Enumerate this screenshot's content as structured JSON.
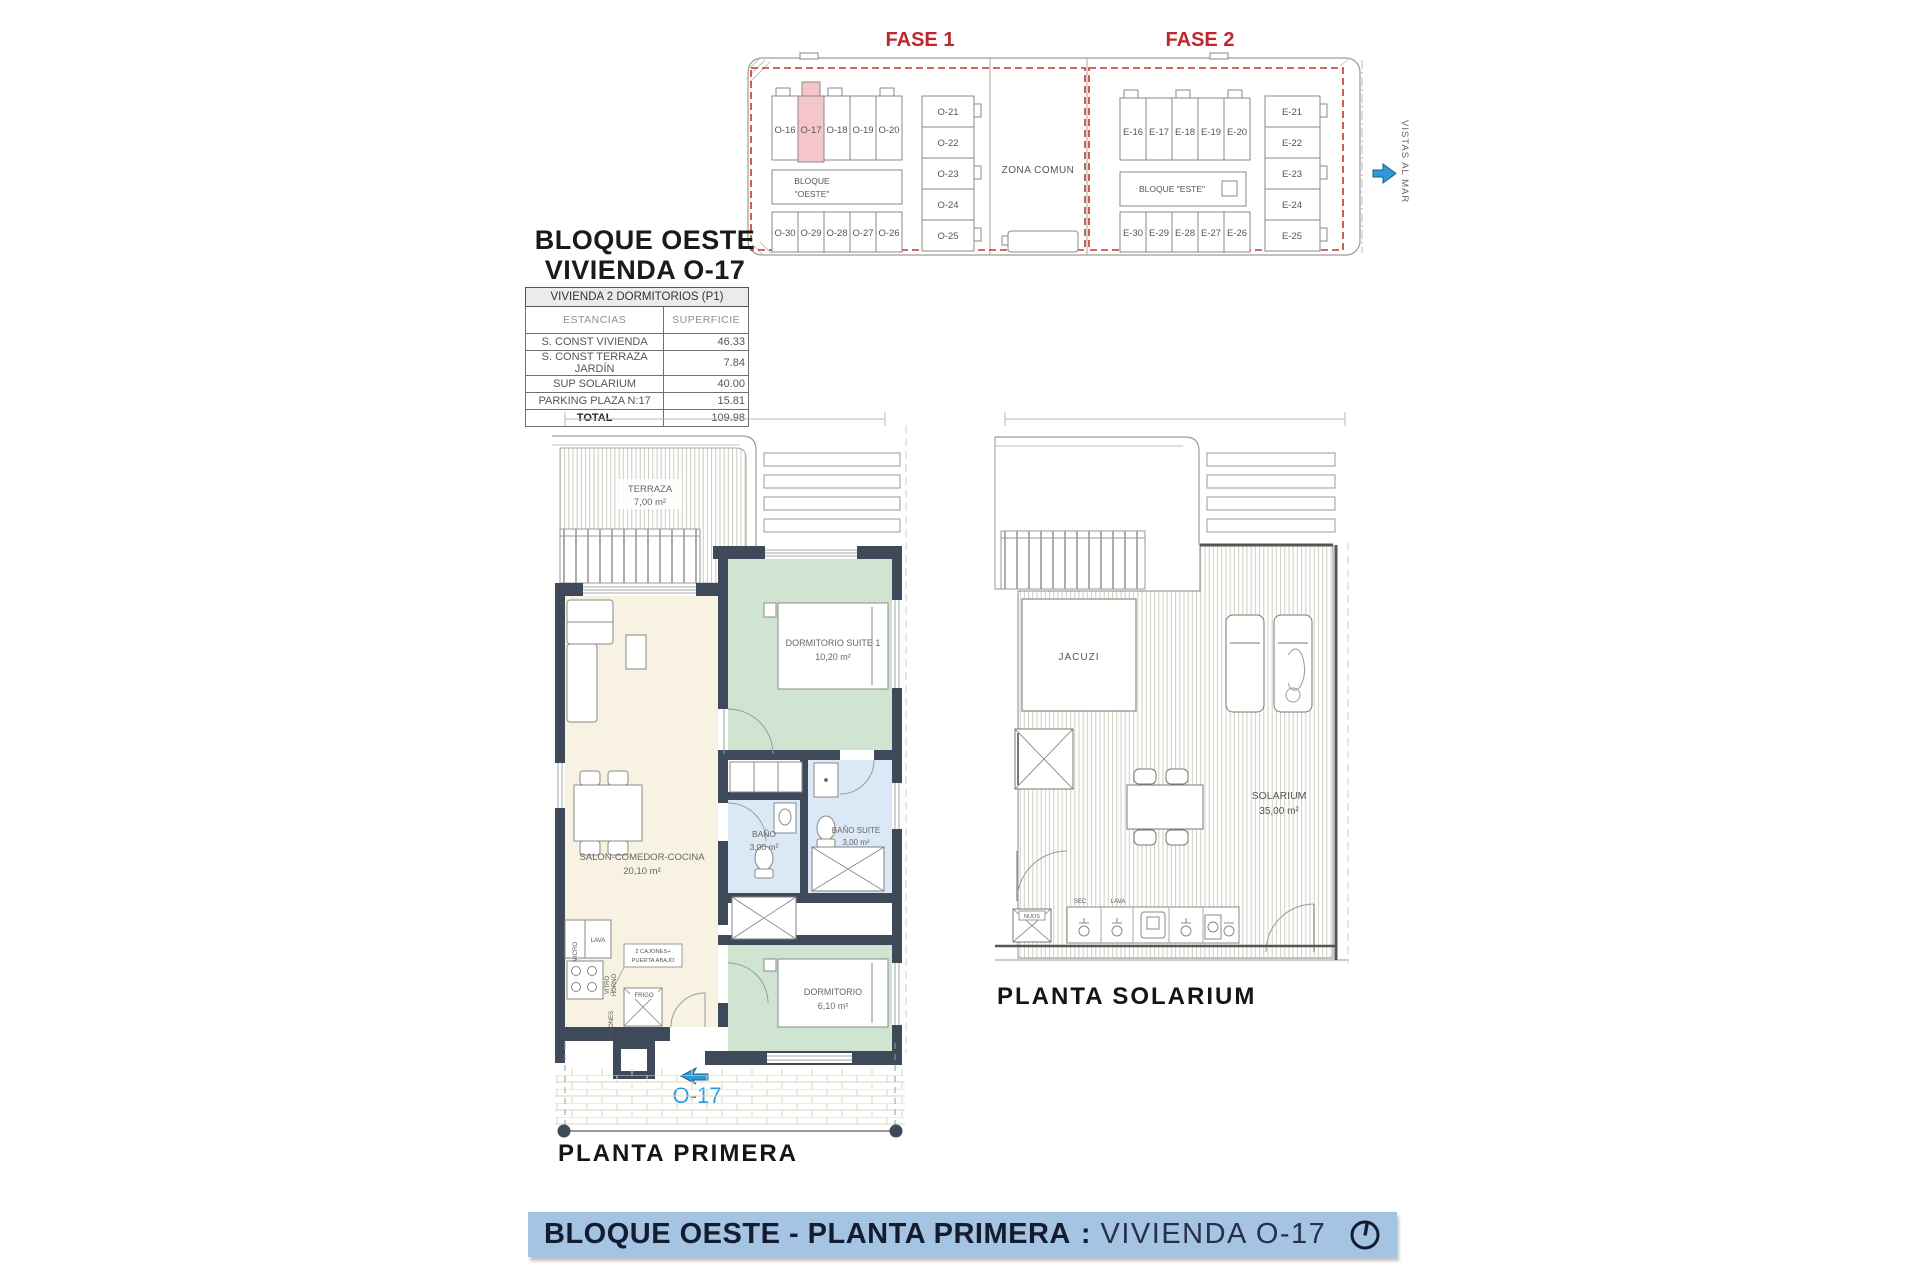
{
  "colors": {
    "accent_red": "#c0272d",
    "highlight_pink": "#f5c6c9",
    "banner_blue": "#a5c3e3",
    "navy_text": "#141c30",
    "wall_dark": "#3e4a59",
    "room_cream": "#f8f2e2",
    "room_green": "#cfe5d1",
    "room_blue": "#dbe8f5",
    "unit_accent_blue": "#2e9ad7"
  },
  "site_plan": {
    "fase1": {
      "label": "FASE 1",
      "top_row": [
        "O-16",
        "O-17",
        "O-18",
        "O-19",
        "O-20"
      ],
      "bottom_row": [
        "O-30",
        "O-29",
        "O-28",
        "O-27",
        "O-26"
      ],
      "right_column": [
        "O-21",
        "O-22",
        "O-23",
        "O-24",
        "O-25"
      ],
      "highlighted_unit": "O-17",
      "block_label_line1": "BLOQUE",
      "block_label_line2": "\"OESTE\""
    },
    "fase2": {
      "label": "FASE 2",
      "top_row": [
        "E-16",
        "E-17",
        "E-18",
        "E-19",
        "E-20"
      ],
      "bottom_row": [
        "E-30",
        "E-29",
        "E-28",
        "E-27",
        "E-26"
      ],
      "right_column": [
        "E-21",
        "E-22",
        "E-23",
        "E-24",
        "E-25"
      ],
      "block_label": "BLOQUE \"ESTE\""
    },
    "zona_comun": "ZONA COMUN",
    "vistas_al_mar": "VISTAS AL MAR"
  },
  "info": {
    "title_line1": "BLOQUE OESTE",
    "title_line2": "VIVIENDA O-17",
    "table": {
      "header": "VIVIENDA 2 DORMITORIOS (P1)",
      "col1": "ESTANCIAS",
      "col2": "SUPERFICIE",
      "rows": [
        {
          "label": "S. CONST VIVIENDA",
          "value": "46.33"
        },
        {
          "label": "S. CONST TERRAZA JARDÍN",
          "value": "7.84"
        },
        {
          "label": "SUP SOLARIUM",
          "value": "40.00"
        },
        {
          "label": "PARKING   PLAZA   N:17",
          "value": "15.81"
        }
      ],
      "total_label": "TOTAL",
      "total_value": "109.98"
    }
  },
  "floor_plan": {
    "caption": "PLANTA PRIMERA",
    "unit_label": "O-17",
    "rooms": {
      "terraza": {
        "name": "TERRAZA",
        "area": "7,00 m²"
      },
      "suite": {
        "name": "DORMITORIO SUITE 1",
        "area": "10,20 m²"
      },
      "salon": {
        "name": "SALON-COMEDOR-COCINA",
        "area": "20,10 m²"
      },
      "bano": {
        "name": "BAÑO",
        "area": "3,00 m²"
      },
      "bano_suite": {
        "name": "BAÑO SUITE",
        "area": "3,00 m²"
      },
      "dormitorio": {
        "name": "DORMITORIO",
        "area": "6,10 m²"
      }
    },
    "kitchen": {
      "micro": "MICRO",
      "lava": "LAVA",
      "vitro": "VITRO",
      "horno": "HORNO",
      "cajones": "CAJONES",
      "frigo": "FRIGO",
      "note_line1": "2 CAJONES+",
      "note_line2": "PUERTA ABAJO"
    }
  },
  "solarium_plan": {
    "caption": "PLANTA SOLARIUM",
    "jacuzi": "JACUZI",
    "solarium_name": "SOLARIUM",
    "solarium_area": "35,00 m²",
    "sec": "SEC",
    "lava": "LAVA",
    "nuos": "NUOS"
  },
  "footer": {
    "bold_text": "BLOQUE OESTE - PLANTA PRIMERA",
    "separator": ":",
    "regular_text": "VIVIENDA O-17"
  }
}
